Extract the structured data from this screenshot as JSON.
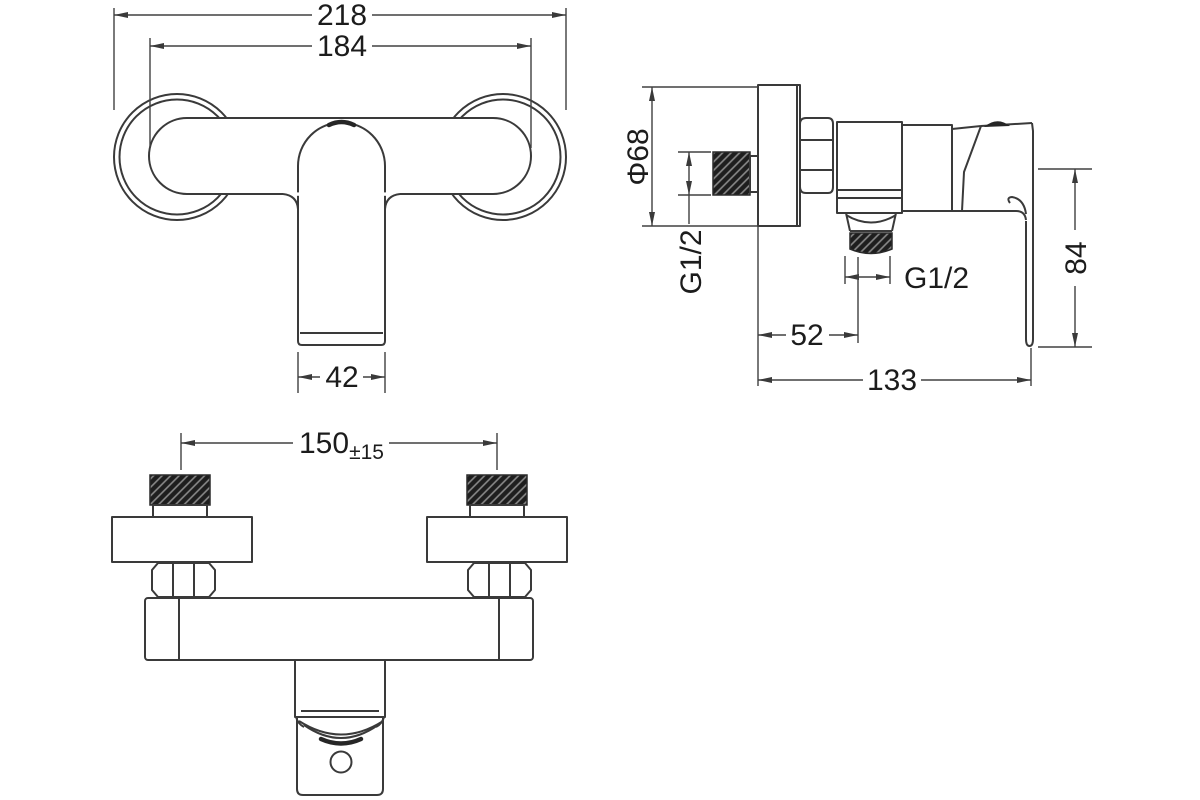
{
  "drawing": {
    "title": "shower-mixer-technical-drawing",
    "colors": {
      "background": "#ffffff",
      "line": "#3a3a3a",
      "text": "#1c1c1c"
    },
    "front_view": {
      "overall_width": "218",
      "mounting_width": "184",
      "handle_width": "42"
    },
    "side_view": {
      "escutcheon_diameter": "Φ68",
      "inlet_thread": "G1/2",
      "outlet_thread": "G1/2",
      "wall_to_outlet": "52",
      "total_depth": "133",
      "handle_drop": "84"
    },
    "bottom_view": {
      "inlet_spacing": "150",
      "inlet_spacing_tolerance": "±15"
    }
  }
}
